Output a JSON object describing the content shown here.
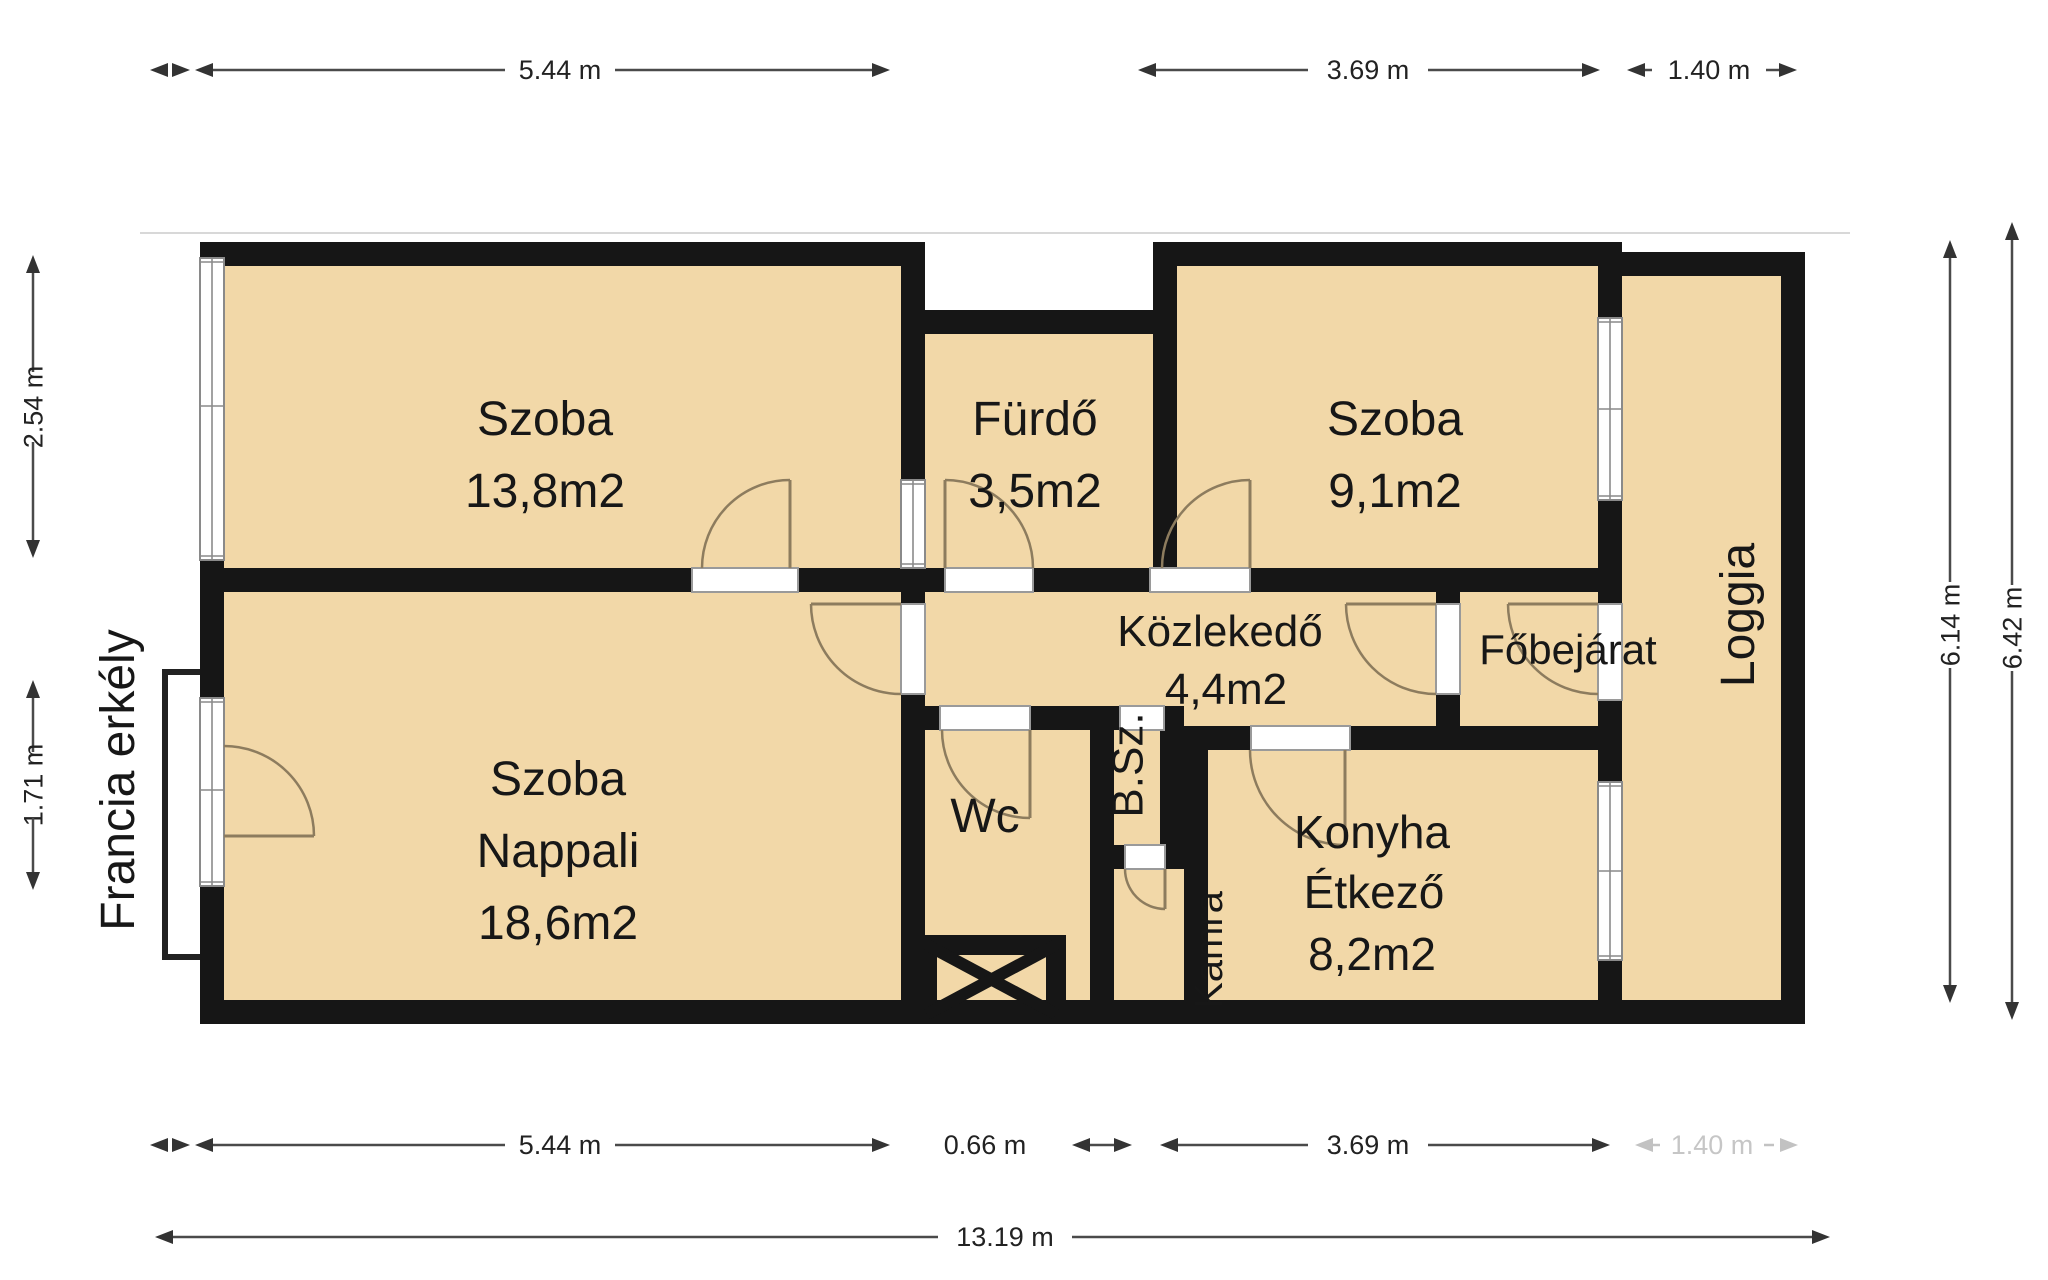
{
  "plan": {
    "rooms": {
      "szoba1": {
        "name": "Szoba",
        "area": "13,8m2"
      },
      "furdo": {
        "name": "Fürdő",
        "area": "3,5m2"
      },
      "szoba2": {
        "name": "Szoba",
        "area": "9,1m2"
      },
      "kozlekedo": {
        "name": "Közlekedő",
        "area": "4,4m2"
      },
      "nappali": {
        "name": "Szoba",
        "name2": "Nappali",
        "area": "18,6m2"
      },
      "wc": {
        "name": "Wc"
      },
      "bsz": {
        "name": "B.Sz."
      },
      "kamra": {
        "name": "Kamra"
      },
      "konyha": {
        "name": "Konyha",
        "name2": "Étkező",
        "area": "8,2m2"
      },
      "fobejarat": {
        "name": "Főbejárat"
      },
      "loggia": {
        "name": "Loggia"
      },
      "francia_erkely": {
        "name": "Francia erkély"
      }
    },
    "dimensions": {
      "top": {
        "d1": "5.44 m",
        "d2": "3.69 m",
        "d3": "1.40 m"
      },
      "bottom": {
        "d1": "5.44 m",
        "d2": "0.66 m",
        "d3": "3.69 m",
        "d4": "1.40 m",
        "total": "13.19 m"
      },
      "left": {
        "d1": "2.54 m",
        "d2": "1.71 m"
      },
      "right": {
        "d1": "6.14 m",
        "d2": "6.42 m"
      }
    },
    "colors": {
      "wall": "#161616",
      "floor": "#f2d8a8",
      "dimension_line": "#4a4a4a",
      "door_arc": "#8d7c5e"
    }
  }
}
